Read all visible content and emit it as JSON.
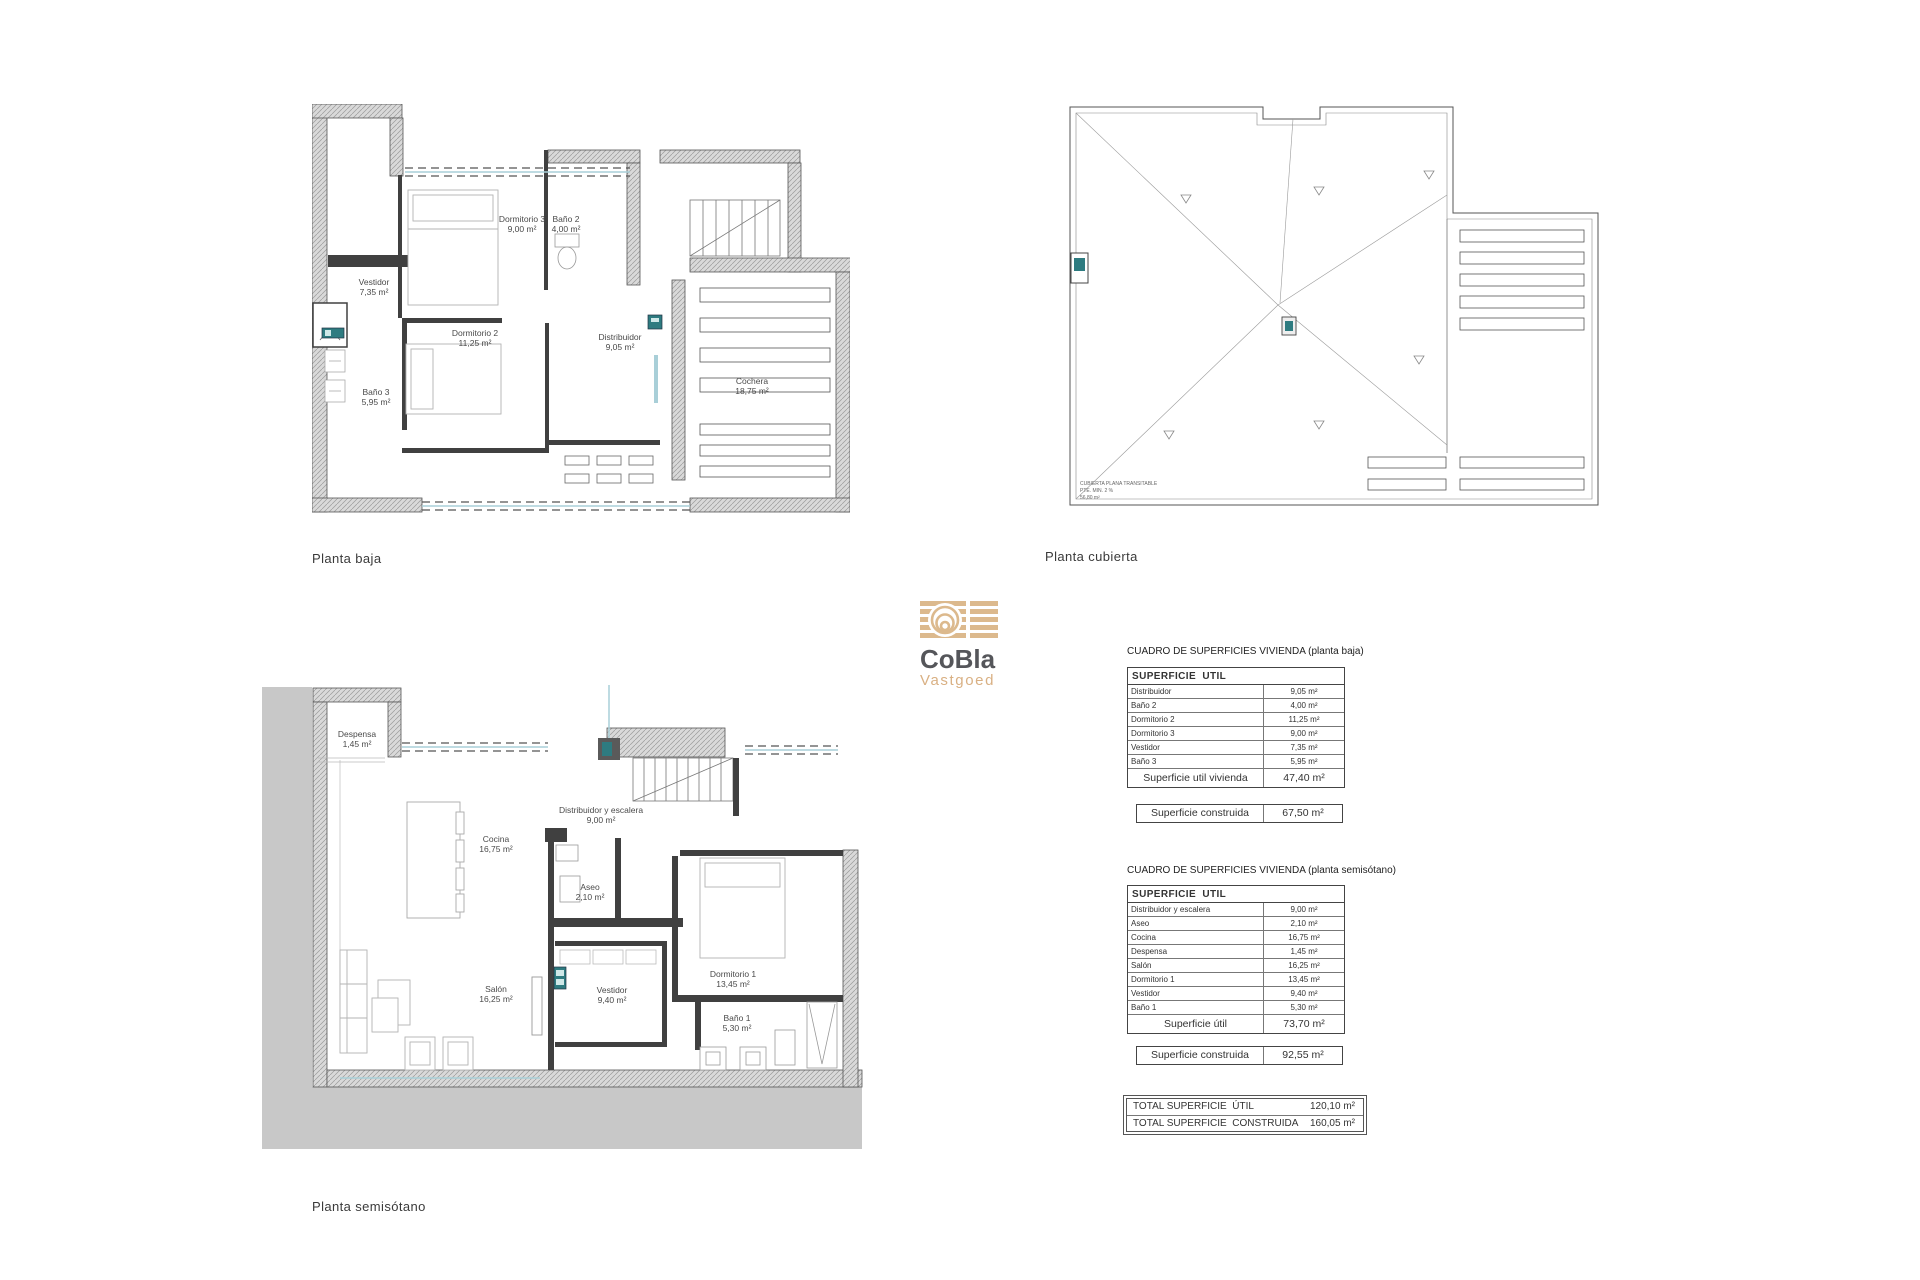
{
  "logo": {
    "brand": "CoBla",
    "sub": "Vastgoed"
  },
  "floor_labels": {
    "baja": "Planta baja",
    "cubierta": "Planta cubierta",
    "semisotano": "Planta semisótano"
  },
  "plans": {
    "baja": {
      "rooms": {
        "dormitorio3": {
          "name": "Dormitorio 3",
          "area": "9,00 m²"
        },
        "bano2": {
          "name": "Baño 2",
          "area": "4,00 m²"
        },
        "vestidor": {
          "name": "Vestidor",
          "area": "7,35 m²"
        },
        "bano3": {
          "name": "Baño 3",
          "area": "5,95 m²"
        },
        "dormitorio2": {
          "name": "Dormitorio 2",
          "area": "11,25 m²"
        },
        "distribuidor": {
          "name": "Distribuidor",
          "area": "9,05 m²"
        },
        "cochera": {
          "name": "Cochera",
          "area": "18,75 m²"
        }
      }
    },
    "cubierta": {
      "note1": "CUBIERTA PLANA TRANSITABLE",
      "note2": "PTE. MIN. 2 %",
      "note3": "56,80 m²"
    },
    "semisotano": {
      "rooms": {
        "despensa": {
          "name": "Despensa",
          "area": "1,45 m²"
        },
        "cocina": {
          "name": "Cocina",
          "area": "16,75 m²"
        },
        "distribuidor": {
          "name": "Distribuidor y escalera",
          "area": "9,00 m²"
        },
        "aseo": {
          "name": "Aseo",
          "area": "2,10 m²"
        },
        "salon": {
          "name": "Salón",
          "area": "16,25 m²"
        },
        "vestidor": {
          "name": "Vestidor",
          "area": "9,40 m²"
        },
        "dormitorio1": {
          "name": "Dormitorio 1",
          "area": "13,45 m²"
        },
        "bano1": {
          "name": "Baño 1",
          "area": "5,30 m²"
        }
      }
    }
  },
  "tables": {
    "baja": {
      "title": "CUADRO DE SUPERFICIES VIVIENDA (planta baja)",
      "header": "SUPERFICIE  UTIL",
      "rows": [
        {
          "label": "Distribuidor",
          "value": "9,05 m²"
        },
        {
          "label": "Baño 2",
          "value": "4,00 m²"
        },
        {
          "label": "Dormitorio 2",
          "value": "11,25 m²"
        },
        {
          "label": "Dormitorio 3",
          "value": "9,00 m²"
        },
        {
          "label": "Vestidor",
          "value": "7,35 m²"
        },
        {
          "label": "Baño 3",
          "value": "5,95 m²"
        }
      ],
      "total_label": "Superficie util vivienda",
      "total_value": "47,40 m²",
      "built_label": "Superficie construida",
      "built_value": "67,50 m²"
    },
    "semisotano": {
      "title": "CUADRO DE SUPERFICIES VIVIENDA (planta semisótano)",
      "header": "SUPERFICIE  UTIL",
      "rows": [
        {
          "label": "Distribuidor y escalera",
          "value": "9,00 m²"
        },
        {
          "label": "Aseo",
          "value": "2,10 m²"
        },
        {
          "label": "Cocina",
          "value": "16,75 m²"
        },
        {
          "label": "Despensa",
          "value": "1,45 m²"
        },
        {
          "label": "Salón",
          "value": "16,25 m²"
        },
        {
          "label": "Dormitorio 1",
          "value": "13,45 m²"
        },
        {
          "label": "Vestidor",
          "value": "9,40 m²"
        },
        {
          "label": "Baño 1",
          "value": "5,30 m²"
        }
      ],
      "total_label": "Superficie útil",
      "total_value": "73,70 m²",
      "built_label": "Superficie construida",
      "built_value": "92,55 m²"
    },
    "totals": {
      "util_label": "TOTAL SUPERFICIE  ÚTIL",
      "util_value": "120,10 m²",
      "built_label": "TOTAL SUPERFICIE  CONSTRUIDA",
      "built_value": "160,05 m²"
    }
  },
  "colors": {
    "accent_tan": "#d9b083",
    "brand_gray": "#55565a",
    "teal": "#2e7b80",
    "window_blue": "#a9cfd8",
    "earth_gray": "#c8c8c8"
  }
}
